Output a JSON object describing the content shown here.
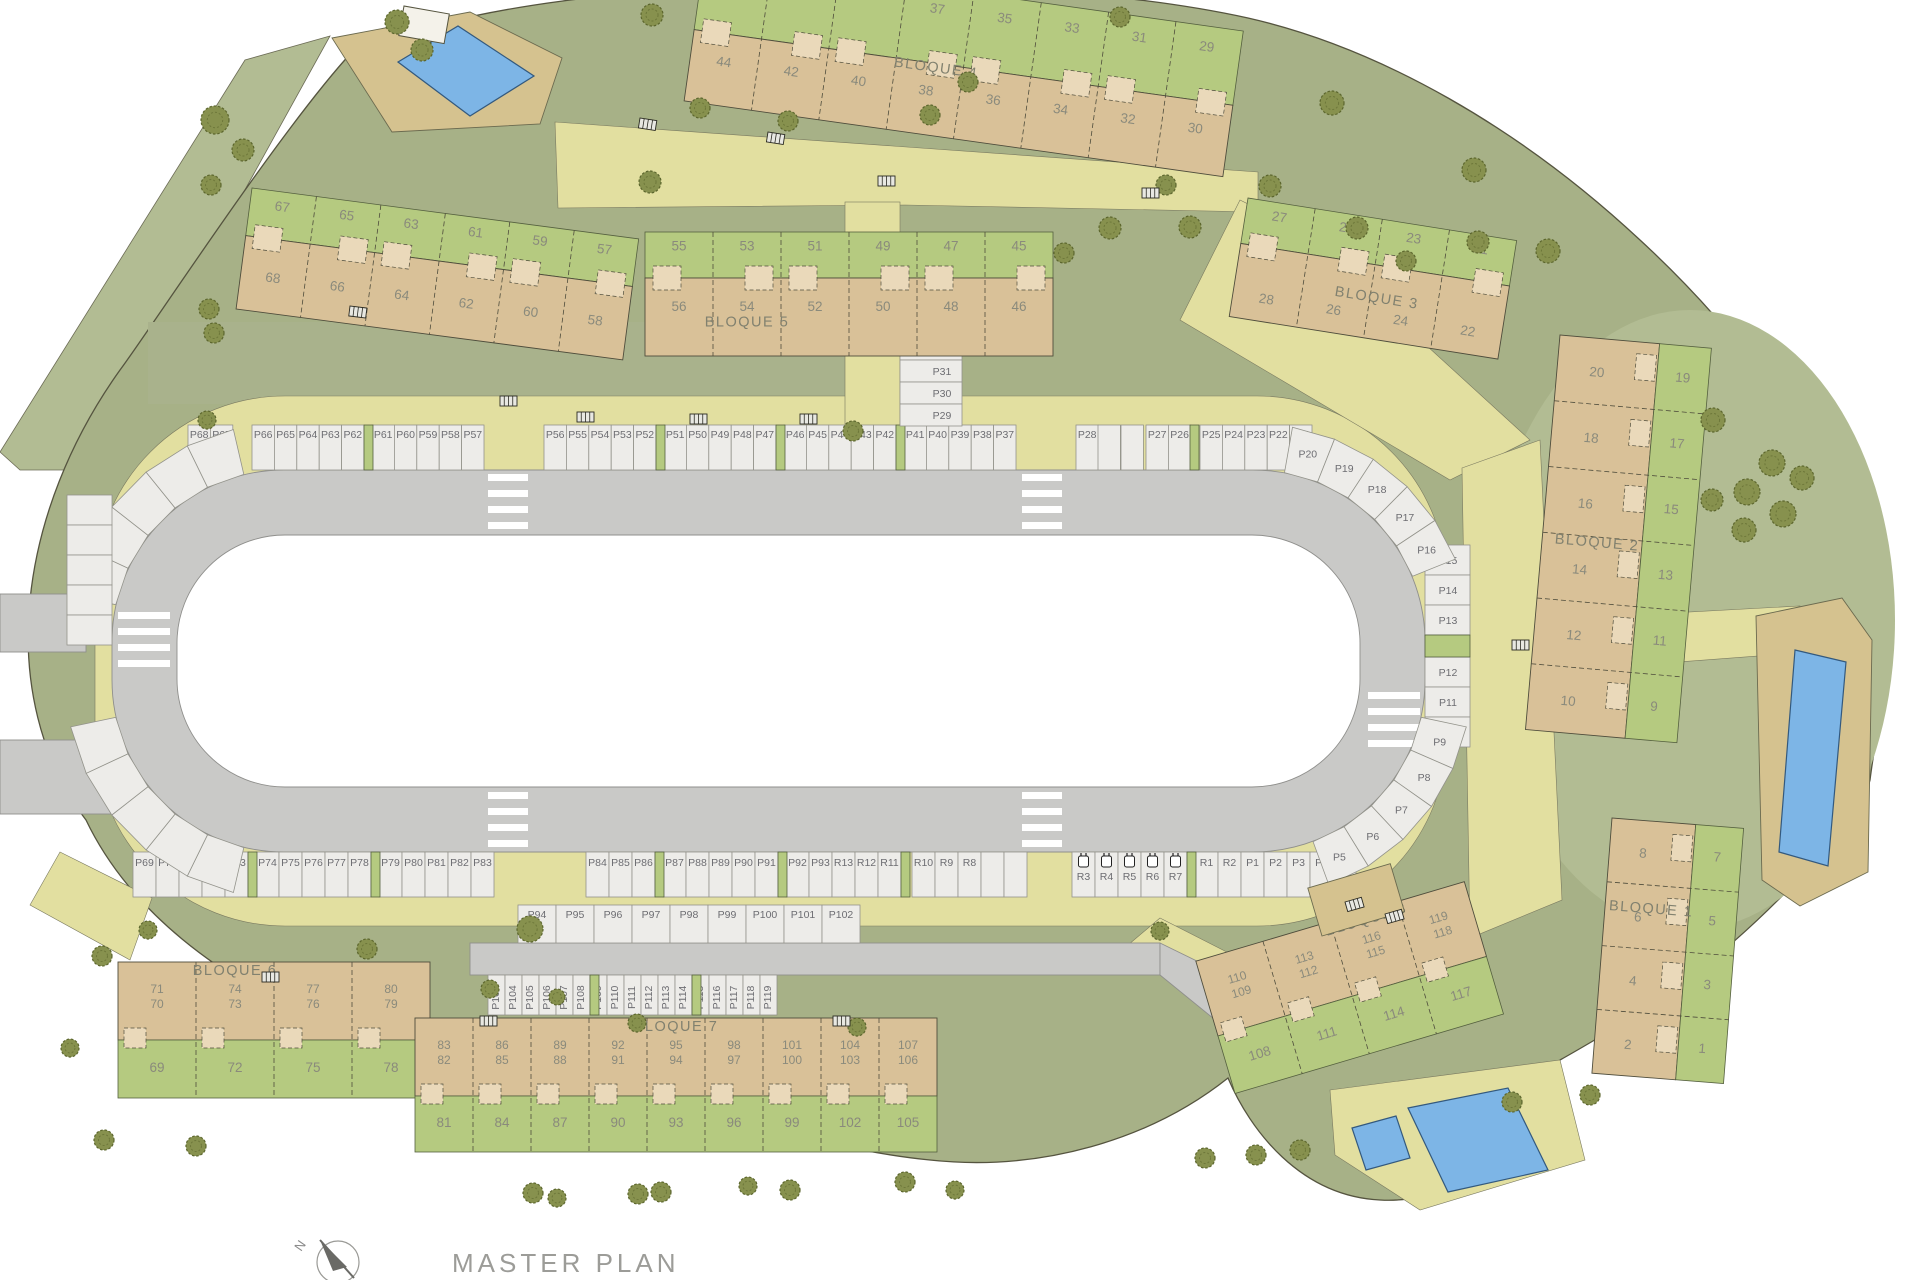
{
  "title": "MASTER PLAN",
  "compass_label": "N",
  "colors": {
    "base-green": "#a7b187",
    "light-green": "#b2bc93",
    "plot-green": "#b5ca80",
    "building-tan": "#d9c198",
    "patio-tan": "#ead9ba",
    "path-yellow": "#e2dfa0",
    "road-grey": "#c9c9c7",
    "stall": "#edece9",
    "pool-blue": "#7db5e6",
    "deck-tan": "#d5c28f",
    "tree-olive": "#87914e",
    "courtyard": "#a9b28c"
  },
  "parking": {
    "top_groups": [
      [
        "P68",
        "P67"
      ],
      [
        "P66",
        "P65",
        "P64",
        "P63",
        "P62"
      ],
      [
        "P61",
        "P60",
        "P59",
        "P58",
        "P57"
      ],
      [
        "P56",
        "P55",
        "P54",
        "P53",
        "P52"
      ],
      [
        "P51",
        "P50",
        "P49",
        "P48",
        "P47"
      ],
      [
        "P46",
        "P45",
        "P44",
        "P43",
        "P42"
      ],
      [
        "P41",
        "P40",
        "P39",
        "P38",
        "P37"
      ],
      [
        "P28"
      ],
      [
        "P27",
        "P26"
      ],
      [
        "P25",
        "P24",
        "P23",
        "P22",
        "P21"
      ]
    ],
    "top_curve": [
      "P20",
      "P19",
      "P18",
      "P17",
      "P16"
    ],
    "right_column": [
      "P15",
      "P14",
      "P13",
      "P12",
      "P11",
      "P10"
    ],
    "right_curve": [
      "P9",
      "P8",
      "P7",
      "P6",
      "P5"
    ],
    "spur_column": [
      "P36",
      "P35",
      "P34",
      "P33",
      "P32",
      "P31",
      "P30",
      "P29"
    ],
    "bottom_groups": [
      [
        "P69",
        "P70",
        "P71",
        "P72",
        "P73"
      ],
      [
        "P74",
        "P75",
        "P76",
        "P77",
        "P78"
      ],
      [
        "P79",
        "P80",
        "P81",
        "P82",
        "P83"
      ],
      [
        "P84",
        "P85",
        "P86"
      ],
      [
        "P87",
        "P88",
        "P89",
        "P90",
        "P91"
      ],
      [
        "P92",
        "P93",
        "R13",
        "R12",
        "R11"
      ],
      [
        "R10",
        "R9",
        "R8"
      ],
      [
        "R3",
        "R4",
        "R5",
        "R6",
        "R7"
      ],
      [
        "R1",
        "R2",
        "P1",
        "P2",
        "P3",
        "P4"
      ]
    ],
    "ev_stalls": [
      "R3",
      "R4",
      "R5",
      "R6",
      "R7"
    ],
    "lane_row": [
      "P94",
      "P95",
      "P96",
      "P97",
      "P98",
      "P99",
      "P100",
      "P101",
      "P102"
    ],
    "lower_row": [
      "P103",
      "P104",
      "P105",
      "P106",
      "P107",
      "P108",
      "P109",
      "P110",
      "P111",
      "P112",
      "P113",
      "P114",
      "P115",
      "P116",
      "P117",
      "P118",
      "P119"
    ]
  },
  "blocks": [
    {
      "id": "terrace-a",
      "name": "",
      "gardens": [
        "67",
        "65",
        "63",
        "61",
        "59",
        "57"
      ],
      "units": [
        "68",
        "66",
        "64",
        "62",
        "60",
        "58"
      ]
    },
    {
      "id": "bloque-5",
      "name": "BLOQUE 5",
      "gardens": [
        "55",
        "53",
        "51",
        "49",
        "47",
        "45"
      ],
      "units": [
        "56",
        "54",
        "52",
        "50",
        "48",
        "46"
      ]
    },
    {
      "id": "bloque-4",
      "name": "BLOQUE 4",
      "gardens": [
        "37",
        "35",
        "33",
        "31",
        "29"
      ],
      "units": [
        "44",
        "42",
        "40",
        "38",
        "36",
        "34",
        "32",
        "30"
      ]
    },
    {
      "id": "bloque-3",
      "name": "BLOQUE 3",
      "gardens": [
        "27",
        "25",
        "23",
        "21"
      ],
      "units": [
        "28",
        "26",
        "24",
        "22"
      ]
    },
    {
      "id": "bloque-2",
      "name": "BLOQUE 2",
      "gardens": [
        "19",
        "17",
        "15",
        "13",
        "11",
        "9"
      ],
      "units": [
        "20",
        "18",
        "16",
        "14",
        "12",
        "10"
      ]
    },
    {
      "id": "bloque-1",
      "name": "BLOQUE 1",
      "gardens": [
        "7",
        "5",
        "3",
        "1"
      ],
      "units": [
        "8",
        "6",
        "4",
        "2"
      ]
    },
    {
      "id": "bloque-6",
      "name": "BLOQUE 6",
      "gardens": [
        "69",
        "72",
        "75",
        "78"
      ],
      "units": [
        [
          "71",
          "70"
        ],
        [
          "74",
          "73"
        ],
        [
          "77",
          "76"
        ],
        [
          "80",
          "79"
        ]
      ]
    },
    {
      "id": "bloque-7",
      "name": "BLOQUE 7",
      "gardens": [
        "81",
        "84",
        "87",
        "90",
        "93",
        "96",
        "99",
        "102",
        "105"
      ],
      "units": [
        [
          "83",
          "82"
        ],
        [
          "86",
          "85"
        ],
        [
          "89",
          "88"
        ],
        [
          "92",
          "91"
        ],
        [
          "95",
          "94"
        ],
        [
          "98",
          "97"
        ],
        [
          "101",
          "100"
        ],
        [
          "104",
          "103"
        ],
        [
          "107",
          "106"
        ]
      ]
    },
    {
      "id": "bloque-8",
      "name": "BLOQUE 8",
      "gardens": [
        "108",
        "111",
        "114",
        "117"
      ],
      "units": [
        [
          "110",
          "109"
        ],
        [
          "113",
          "112"
        ],
        [
          "116",
          "115"
        ],
        [
          "119",
          "118"
        ]
      ]
    }
  ]
}
